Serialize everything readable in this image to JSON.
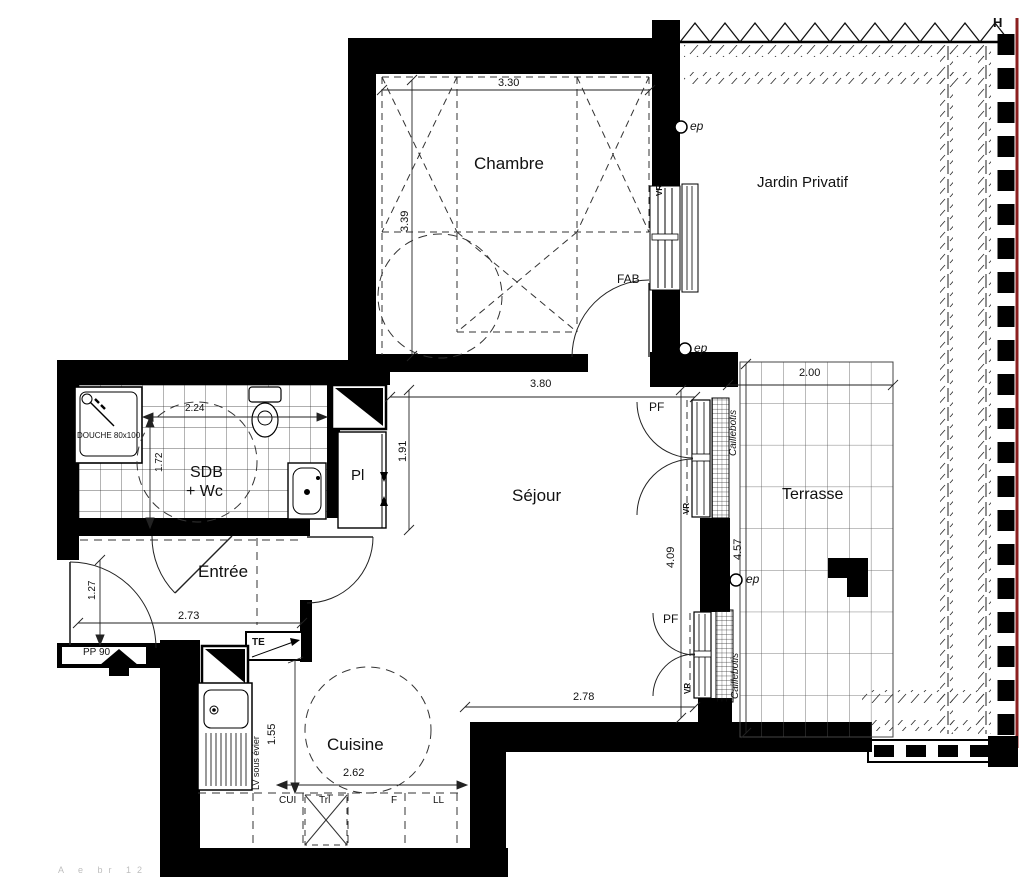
{
  "rooms": {
    "chambre": "Chambre",
    "jardin": "Jardin Privatif",
    "sdb_line1": "SDB",
    "sdb_line2": "+ Wc",
    "entree": "Entrée",
    "sejour": "Séjour",
    "terrasse": "Terrasse",
    "cuisine": "Cuisine",
    "placard": "Pl"
  },
  "dimensions": {
    "chambre_w": "3.30",
    "chambre_h": "3.39",
    "sdb_w": "2.24",
    "sdb_h": "1.72",
    "entree_h": "1.27",
    "entree_w": "2.73",
    "sejour_w_top": "3.80",
    "sejour_h_left": "1.91",
    "sejour_h_right": "4.09",
    "sejour_w_bottom": "2.78",
    "cuisine_h": "1.55",
    "cuisine_w": "2.62",
    "terrasse_w": "2.00",
    "terrasse_h": "4.57"
  },
  "annotations": {
    "douche": "DOUCHE 80x100",
    "porte_palliere": "PP 90",
    "tableau_electrique": "TE",
    "fab": "FAB",
    "volet_roulant": "VR",
    "porte_fenetre": "PF",
    "eau_pluviale": "ep",
    "h_marker": "H",
    "caillebotis": "Caillebotis",
    "lave_vaisselle": "LV sous évier",
    "cuisiniere": "CUI",
    "tri": "Trl",
    "frigo": "F",
    "lave_linge": "LL",
    "margin_note": "A  e br  12"
  },
  "colors": {
    "wall": "#000000",
    "line": "#1a1a1a",
    "boundary_red": "#8b1f1f"
  }
}
